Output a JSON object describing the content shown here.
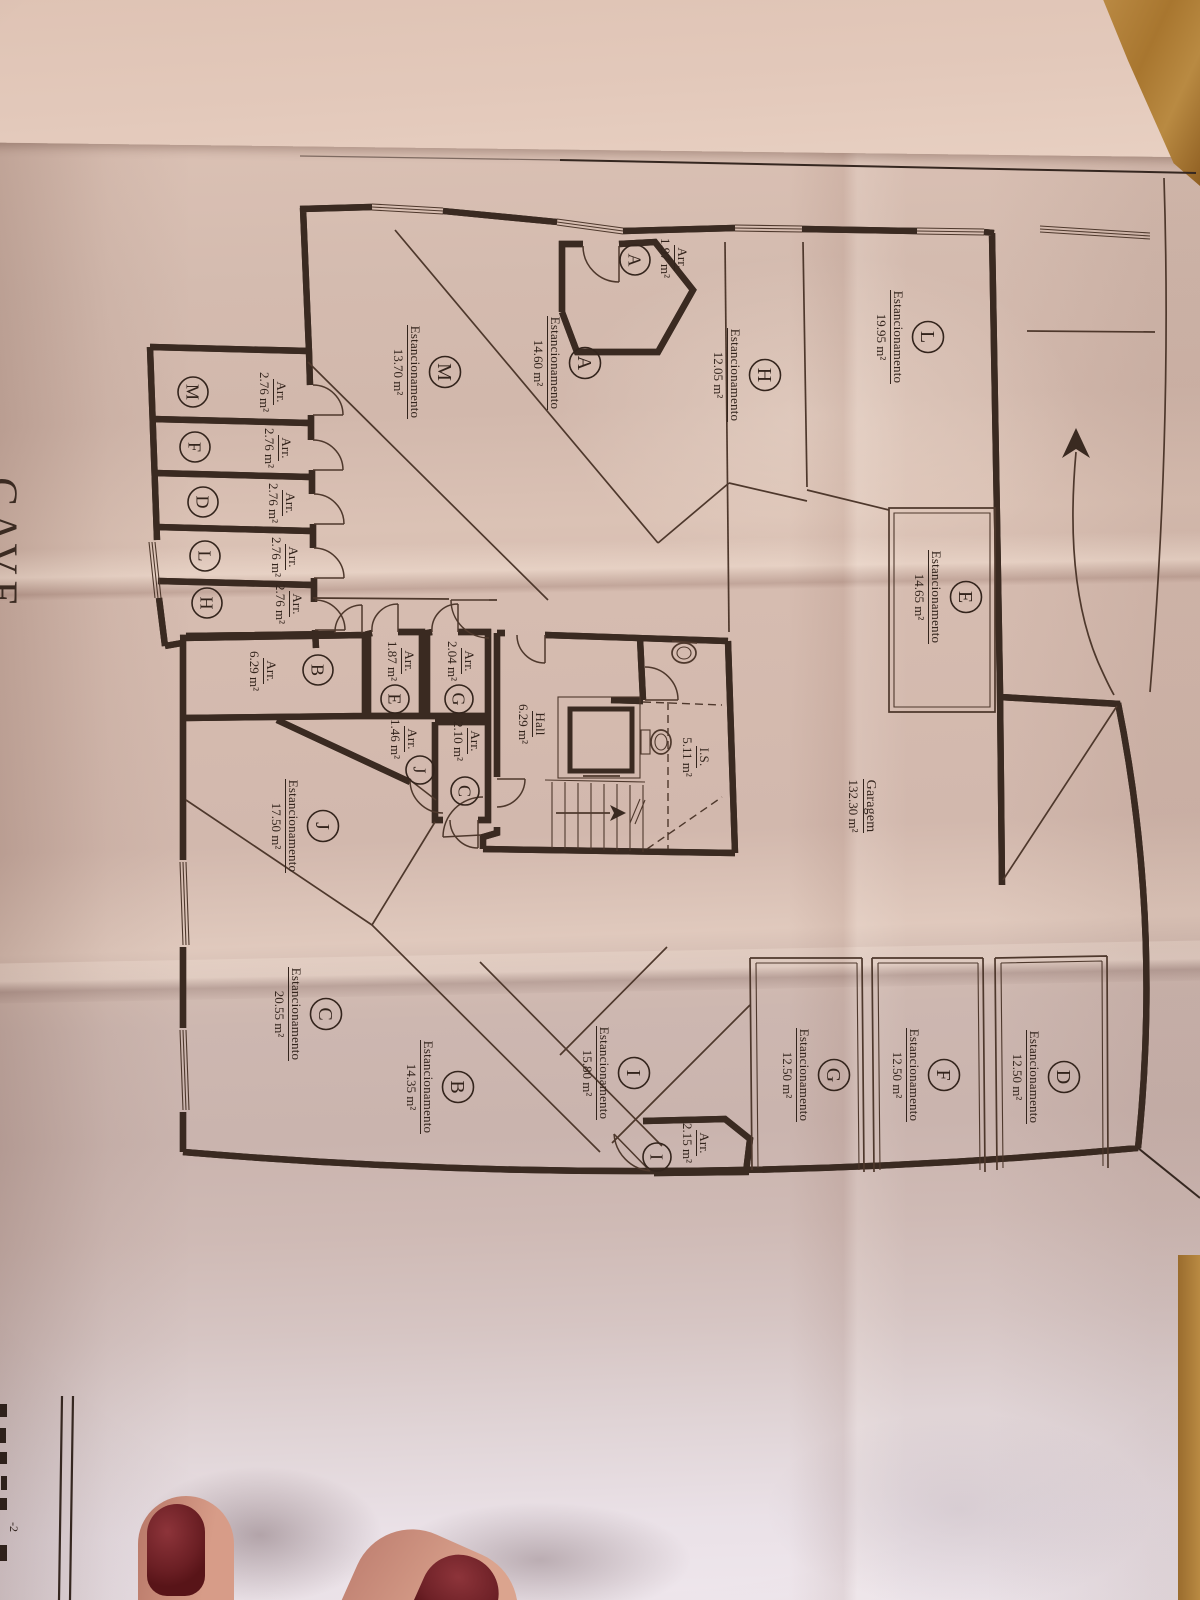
{
  "floor": {
    "title": "CAVE"
  },
  "legend_labels": {
    "parking": "Estancionamento",
    "storage": "Arr."
  },
  "garage": {
    "name": "Garagem",
    "area": "132.30 m²"
  },
  "hall": {
    "name": "Hall",
    "area": "6.29 m²"
  },
  "sanitary": {
    "name": "I.S.",
    "area": "5.11 m²"
  },
  "parking_spaces": [
    {
      "letter": "L",
      "area": "19.95 m²"
    },
    {
      "letter": "H",
      "area": "12.05 m²"
    },
    {
      "letter": "A",
      "area": "14.60 m²"
    },
    {
      "letter": "M",
      "area": "13.70 m²"
    },
    {
      "letter": "E",
      "area": "14.65 m²"
    },
    {
      "letter": "J",
      "area": "17.50 m²"
    },
    {
      "letter": "C",
      "area": "20.55 m²"
    },
    {
      "letter": "B",
      "area": "14.35 m²"
    },
    {
      "letter": "I",
      "area": "15.80 m²"
    },
    {
      "letter": "G",
      "area": "12.50 m²"
    },
    {
      "letter": "F",
      "area": "12.50 m²"
    },
    {
      "letter": "D",
      "area": "12.50 m²"
    }
  ],
  "storage_rooms": [
    {
      "letter": "A",
      "area": "1.97 m²"
    },
    {
      "letter": "M",
      "area": "2.76 m²"
    },
    {
      "letter": "F",
      "area": "2.76 m²"
    },
    {
      "letter": "D",
      "area": "2.76 m²"
    },
    {
      "letter": "L",
      "area": "2.76 m²"
    },
    {
      "letter": "H",
      "area": "2.76 m²"
    },
    {
      "letter": "B",
      "area": "6.29 m²"
    },
    {
      "letter": "E",
      "area": "1.87 m²"
    },
    {
      "letter": "G",
      "area": "2.04 m²"
    },
    {
      "letter": "J",
      "area": "1.46 m²"
    },
    {
      "letter": "C",
      "area": "2.10 m²"
    },
    {
      "letter": "I",
      "area": "2.15 m²"
    }
  ],
  "sheet": {
    "corner_fragment": "-2"
  },
  "colors": {
    "paper": "#d5bbaf",
    "ink": "#3a2a21",
    "wood": "#b5813d",
    "nail_polish": "#6d2025",
    "skin": "#cf9585"
  }
}
